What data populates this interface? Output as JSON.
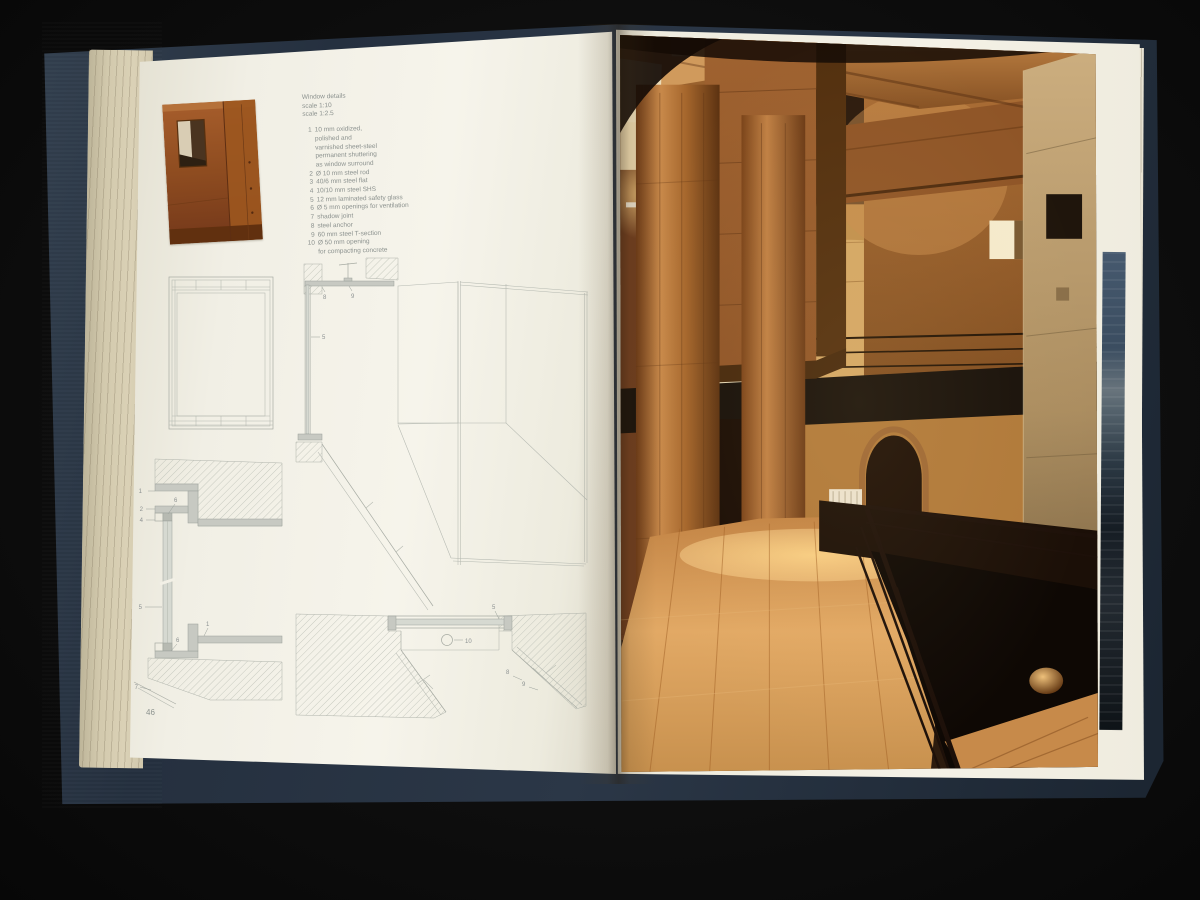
{
  "palette": {
    "background": "#0d0d0d",
    "cover_navy": "#2a3646",
    "page_cream": "#f4f2e9",
    "drawing_line_gray": "#a7aba3",
    "legend_text_gray": "#8b918e",
    "photo_wood_warm": "#a9672c",
    "photo_floor_wood": "#d99f5c",
    "photo_steel_dark": "#17100a",
    "rust_steel": "#96501f"
  },
  "book": {
    "left_page": {
      "page_number": "46",
      "caption": {
        "title": "Window details",
        "scale_1": "scale 1:10",
        "scale_2": "scale 1:2.5"
      },
      "legend": [
        {
          "num": "1",
          "text": "10 mm oxidized,\npolished and\nvarnished sheet-steel\npermanent shuttering\nas window surround"
        },
        {
          "num": "2",
          "text": "Ø 10 mm steel rod"
        },
        {
          "num": "3",
          "text": "40/6 mm steel flat"
        },
        {
          "num": "4",
          "text": "10/10 mm steel SHS"
        },
        {
          "num": "5",
          "text": "12 mm laminated safety glass"
        },
        {
          "num": "6",
          "text": "Ø 5 mm openings for ventilation"
        },
        {
          "num": "7",
          "text": "shadow joint"
        },
        {
          "num": "8",
          "text": "steel anchor"
        },
        {
          "num": "9",
          "text": "60 mm steel T-section"
        },
        {
          "num": "10",
          "text": "Ø 50 mm opening\nfor compacting concrete"
        }
      ],
      "callouts": {
        "section": {
          "n8": "8",
          "n9": "9",
          "n5": "5"
        },
        "vertical_detail": {
          "n1": "1",
          "n2": "2",
          "n4": "4",
          "n6": "6",
          "n5": "5",
          "n1b": "1",
          "n6b": "6",
          "n7": "7"
        },
        "horizontal_detail": {
          "n5": "5",
          "n10": "10",
          "n8": "8",
          "n9": "9"
        }
      }
    },
    "right_page": {
      "photo_subject": "interior with round timber columns, stone walls, steel mezzanine and arched opening"
    }
  }
}
